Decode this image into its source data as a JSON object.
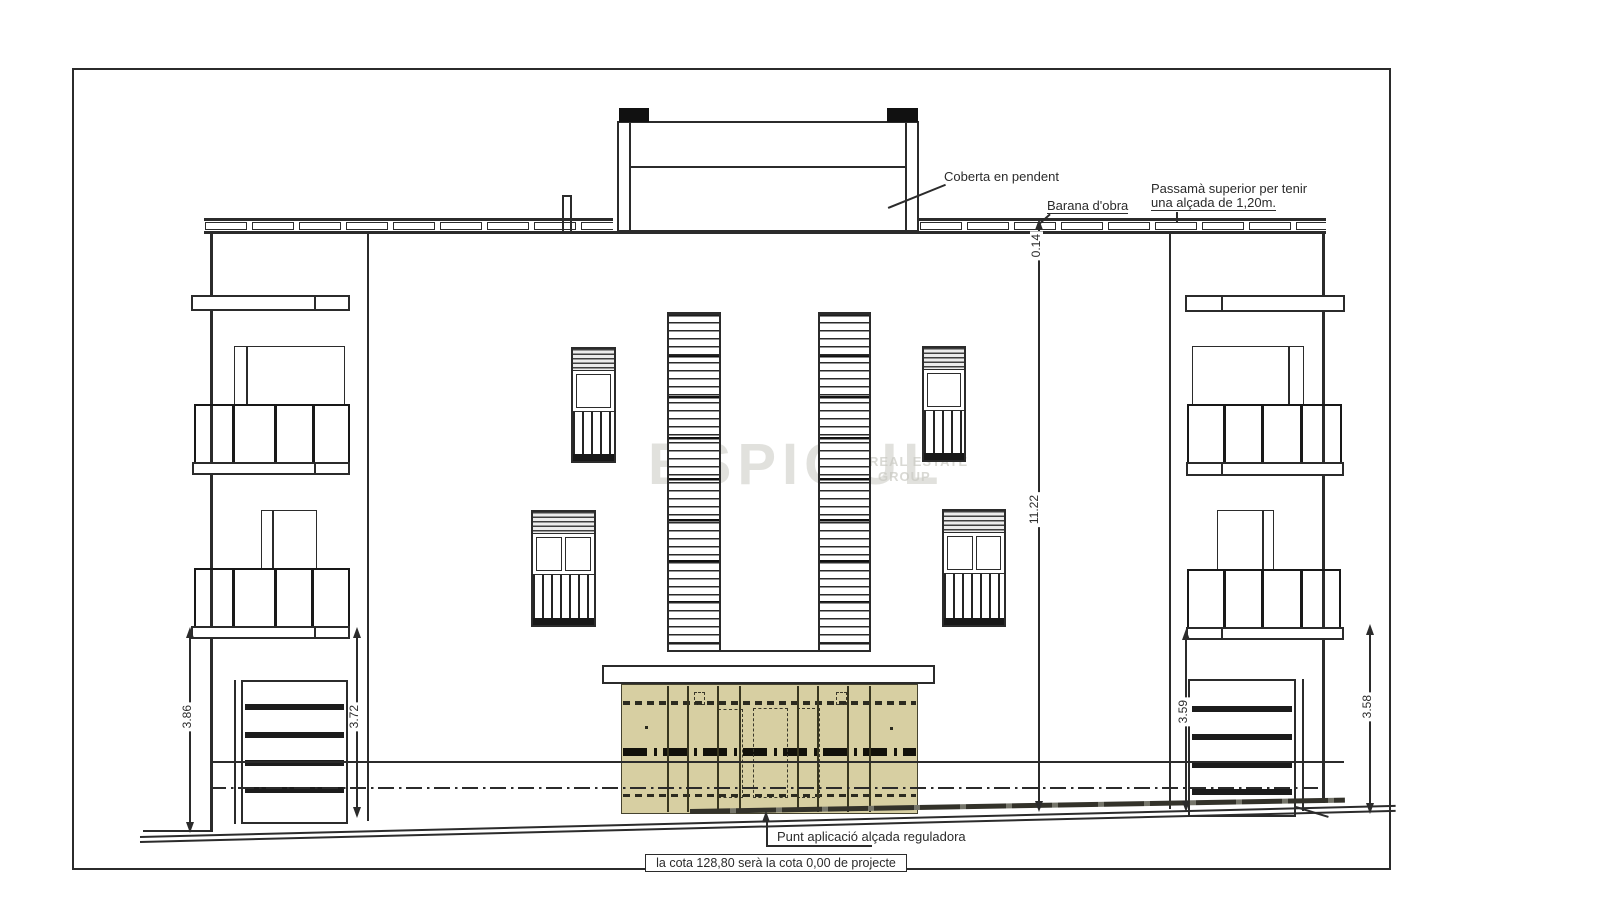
{
  "drawing": {
    "colors": {
      "line": "#2b2b2b",
      "fence": "#d7cfa2",
      "watermark": "#c9c9c2"
    },
    "annotations": {
      "coberta": "Coberta en pendent",
      "barana": "Barana d'obra",
      "passama1": "Passamà superior per tenir",
      "passama2": "una alçada de 1,20m.",
      "punt": "Punt aplicació alçada reguladora",
      "cota": "la cota 128,80 serà la cota 0,00 de projecte"
    },
    "dimensions": {
      "parapet": "0.14",
      "total_height": "11.22",
      "left_outer": "3.86",
      "left_inner": "3.72",
      "right_inner": "3.59",
      "right_outer": "3.58"
    },
    "watermark": {
      "main": "ESPIGUL",
      "sub1": "REAL ESTATE",
      "sub2": "GROUP"
    }
  }
}
